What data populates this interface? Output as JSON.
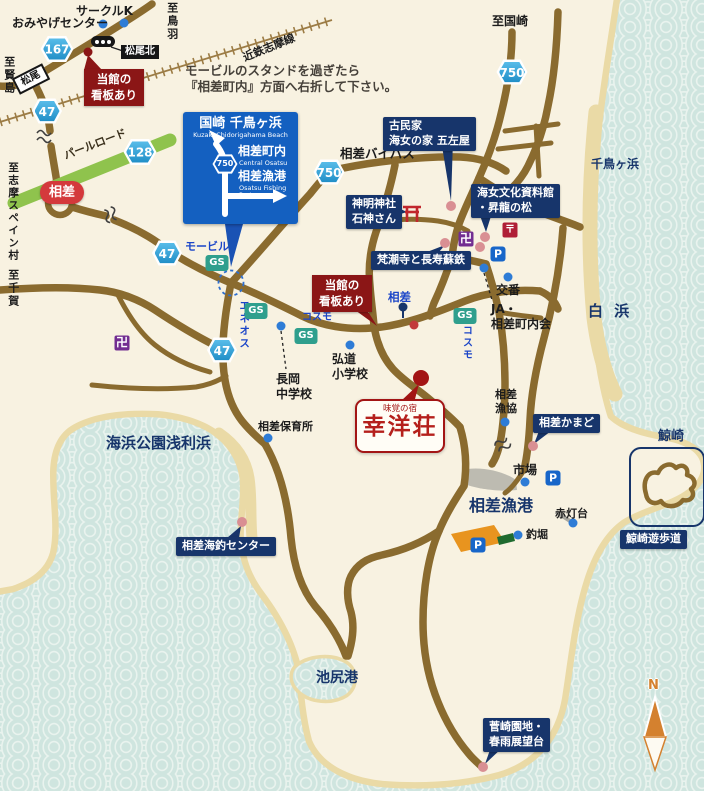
{
  "instruction": "モービルのスタンドを過ぎたら\n『相差町内』方面へ右折して下さい。",
  "road_sign": {
    "dest_top_jp": "国崎 千鳥ヶ浜",
    "dest_top_en": "Kuzaki   Chidorigahama Beach",
    "dest_mid_jp": "相差町内",
    "dest_mid_en": "Central Osatsu",
    "dest_bot_jp": "相差漁港",
    "dest_bot_en": "Osatsu Fishing Port",
    "route": "750"
  },
  "route_badges": {
    "r167": "167",
    "r128": "128",
    "r47": "47",
    "r750": "750"
  },
  "railway": {
    "line_name": "近鉄志摩線",
    "matsuo_station": "松尾"
  },
  "signals": {
    "matsuo_kita": "松尾北",
    "osatsu": "相差"
  },
  "directions": {
    "toba": "至鳥羽",
    "kashikojima": "至賢島",
    "kuzaki": "至国崎",
    "spain_mura": "至志摩スペイン村",
    "chiga": "至千賀"
  },
  "roads": {
    "pearl_road": "パールロード",
    "osatsu_bypass": "相差バイパス",
    "osatsu_ic": "相差"
  },
  "gas": {
    "mobil": "モービル",
    "eneos": "エネオス",
    "cosmo": "コスモ"
  },
  "inn": {
    "tagline": "味覚の宿",
    "name": "幸洋荘",
    "sign_note": "当館の\n看板あり"
  },
  "pois": {
    "circle_k": "サークルK",
    "omiyage": "おみやげセンター",
    "gozaya": "古民家\n海女の家 五左屋",
    "ama_museum": "海女文化資料館\n・昇龍の松",
    "shinmei": "神明神社\n石神さん",
    "bonshoji": "梵潮寺と長寿蘇鉄",
    "koban": "交番",
    "ja": "JA・\n相差町内会",
    "kodo": "弘道\n小学校",
    "nagaoka": "長岡\n中学校",
    "hoikusho": "相差保育所",
    "gyokyo": "相差\n漁協",
    "kamado": "相差かまど",
    "ichiba": "市場",
    "akatodai": "赤灯台",
    "tsuribori": "釣堀",
    "yuhodo": "鯨崎遊歩道",
    "tsuri_center": "相差海釣センター",
    "sugesaki": "菅崎園地・\n春雨展望台"
  },
  "areas": {
    "shirahama": "白 浜",
    "chidorigahama": "千鳥ヶ浜",
    "kujirazaki": "鯨崎",
    "kaihin_koen": "海浜公園浅利浜",
    "osatsu_gyoko": "相差漁港",
    "ikejiri": "池尻港"
  },
  "icons": {
    "gs": "GS",
    "parking": "P",
    "temple": "卍",
    "post_office": "〒",
    "north": "N"
  },
  "colors": {
    "sea": "#cfe5df",
    "sea_arc": "#e9f3ee",
    "land": "#f8f2e1",
    "sand": "#eadaa6",
    "road": "#8a6b2f",
    "pearl_green": "#8fc34d",
    "navy": "#17356b",
    "sign_blue": "#1460c0",
    "red_badge": "#d4393c",
    "dark_red": "#8b1616",
    "route_blue": "#2aa3db",
    "gs_teal": "#2f9f8d",
    "parking_blue": "#1866c9",
    "temple_purple": "#722d91",
    "post_red": "#b01e36"
  }
}
